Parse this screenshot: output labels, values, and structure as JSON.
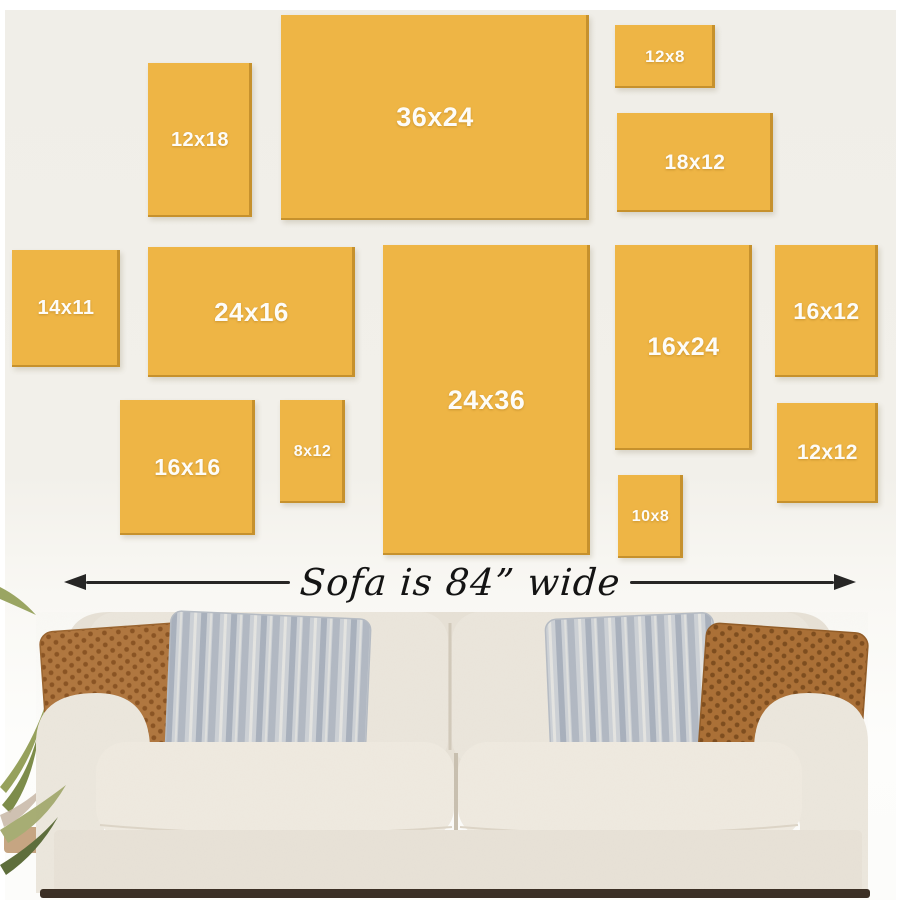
{
  "frames": [
    {
      "label": "12x18"
    },
    {
      "label": "36x24"
    },
    {
      "label": "12x8"
    },
    {
      "label": "18x12"
    },
    {
      "label": "14x11"
    },
    {
      "label": "24x16"
    },
    {
      "label": "24x36"
    },
    {
      "label": "16x24"
    },
    {
      "label": "16x12"
    },
    {
      "label": "16x16"
    },
    {
      "label": "8x12"
    },
    {
      "label": "10x8"
    },
    {
      "label": "12x12"
    }
  ],
  "arrow": {
    "label": "Sofa is 84” wide"
  },
  "colors": {
    "frame_fill": "#eeb545",
    "frame_edge_shadow": "#a6731a",
    "frame_label_text": "#fdfcf8",
    "wall_top": "#f0eee8",
    "wall_bottom": "#fdfdfb",
    "arrow": "#272625",
    "arrow_text": "#141414",
    "sofa_fabric": "#ebe6dc",
    "sofa_base": "#e8e2d7",
    "pillow_brown": "#b0773f",
    "pillow_brown_dots": "#8a5423",
    "pillow_gray": "#cdd1d6",
    "pillow_gray_stripe": "#a9b1bd",
    "plant_green": "#96a15c",
    "floor_shadow": "#3b2f24"
  }
}
